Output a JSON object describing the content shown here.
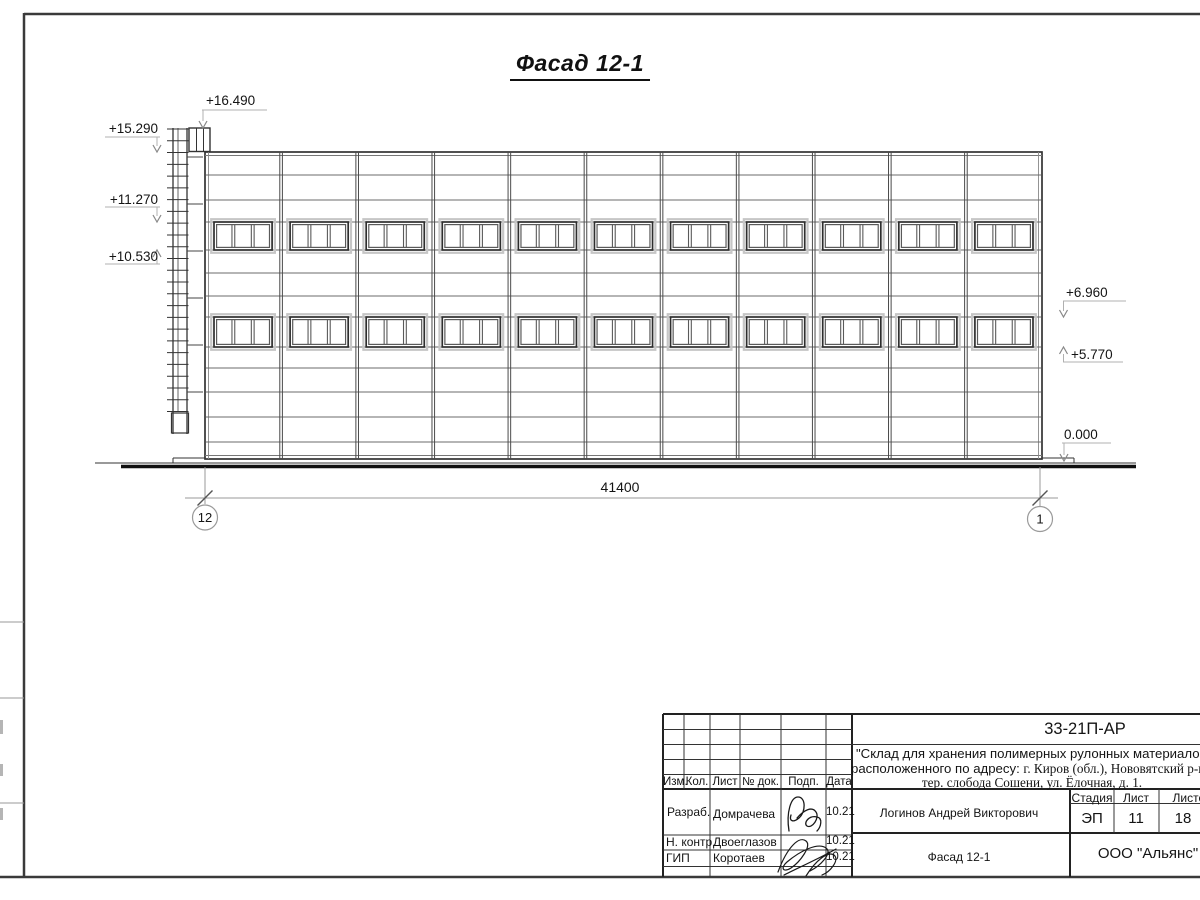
{
  "sheet": {
    "title": "Фасад 12-1"
  },
  "drawing": {
    "dimension_total": "41400",
    "axis_left": "12",
    "axis_right": "1",
    "elevations_left": [
      "+16.490",
      "+15.290",
      "+11.270",
      "+10.530"
    ],
    "elevations_right": [
      "+6.960",
      "+5.770",
      "0.000"
    ],
    "facade": {
      "bays": 11,
      "window_rows": 2,
      "panes_per_window": 3,
      "ladder_rungs": 25
    }
  },
  "title_block": {
    "doc_number": "33-21П-АР",
    "project_name_line1": "\"Склад для хранения полимерных рулонных материалов,",
    "project_name_line2_prefix": "расположенного по адресу: ",
    "project_name_line2_serif": "г. Киров (обл.), Нововятский р-н,",
    "project_name_line3": "тер. слобода Сошени, ул. Ёлочная, д. 1.",
    "change_table": {
      "izm": "Изм.",
      "kol": "Кол.",
      "list": "Лист",
      "doc_no": "№ док.",
      "podp": "Подп.",
      "data": "Дата"
    },
    "stage": {
      "header_stage": "Стадия",
      "header_sheet": "Лист",
      "header_sheets": "Листов",
      "stage": "ЭП",
      "sheet": "11",
      "sheets": "18"
    },
    "roles": [
      {
        "role": "Разраб.",
        "name": "Домрачева",
        "date": "10.21"
      },
      {
        "role": "Н. контр.",
        "name": "Двоеглазов",
        "date": "10.21"
      },
      {
        "role": "ГИП",
        "name": "Коротаев",
        "date": "10.21"
      }
    ],
    "supervisor": "Логинов Андрей Викторович",
    "sheet_name": "Фасад 12-1",
    "company": "ООО \"Альянс\""
  }
}
